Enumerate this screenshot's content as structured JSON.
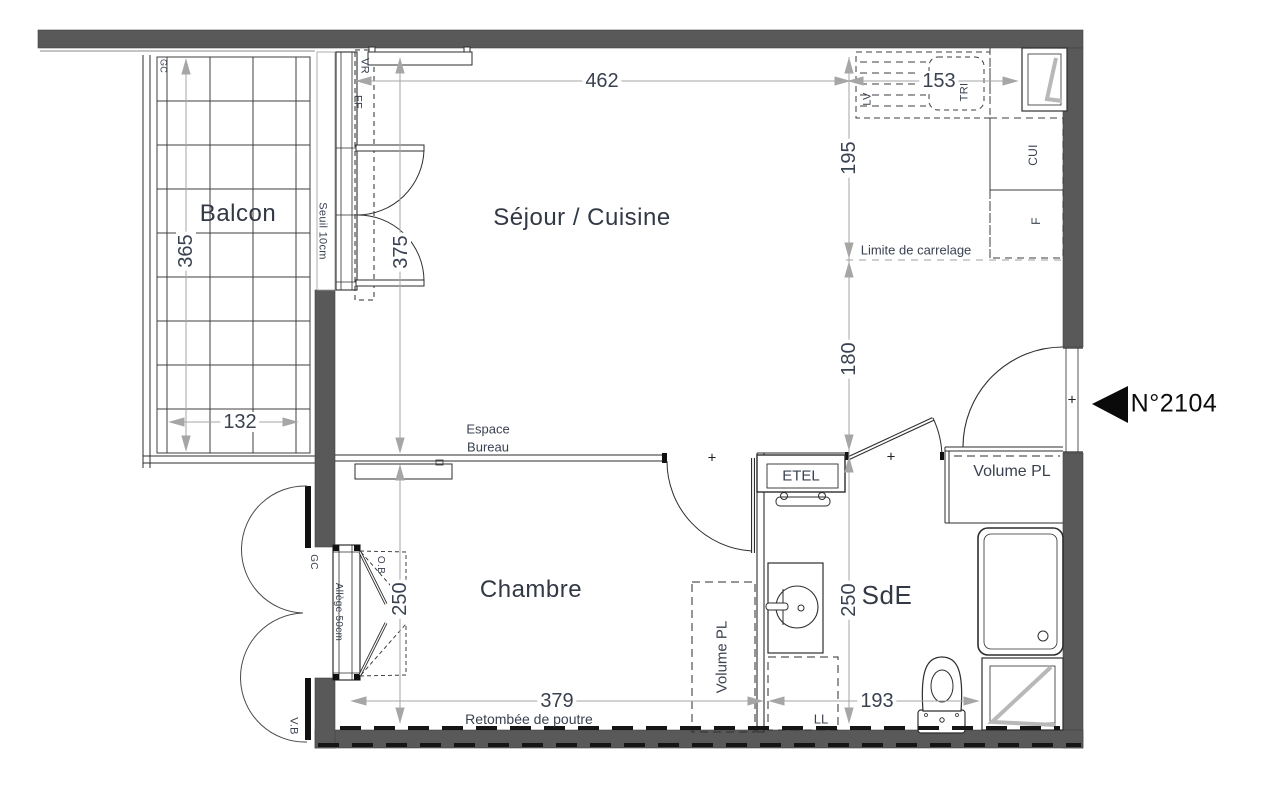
{
  "unit_label": "N°2104",
  "rooms": {
    "balcony": "Balcon",
    "living_kitchen": "Séjour / Cuisine",
    "bedroom": "Chambre",
    "shower_room": "SdE"
  },
  "dimensions_cm": {
    "living_width": "462",
    "kitchen_counter": "153",
    "kitchen_depth": "195",
    "living_depth": "375",
    "balcony_depth": "365",
    "balcony_width": "132",
    "tiling_to_wall": "180",
    "bedroom_depth": "250",
    "shower_room_depth": "250",
    "bedroom_width": "379",
    "shower_room_width": "193"
  },
  "annotations": {
    "tiling_limit": "Limite de carrelage",
    "desk_line1": "Espace",
    "desk_line2": "Bureau",
    "threshold": "Seuil 10cm",
    "sill": "Allège 50cm",
    "beam": "Retombée de poutre",
    "closet_entry": "Volume PL",
    "closet_bedroom": "Volume PL",
    "electrical_panel": "ETEL",
    "washing_machine": "LL",
    "dishwasher": "LV",
    "sorting_bin": "TRI",
    "kitchen_unit": "CUI",
    "fridge": "F",
    "roller_shutter": "VR",
    "fixed_frame": "FF",
    "guardrail_balcony": "GC",
    "guardrail_window": "GC",
    "swing_shutter": "V.B",
    "casement": "O.B",
    "door_axis_mark": "+"
  },
  "colors": {
    "wall": "#595959",
    "line": "#2e2e2e",
    "dim-line": "#a6a6a6",
    "dim-text": "#3a4150",
    "label-text": "#333845",
    "window-mark": "#b8b8b8"
  }
}
